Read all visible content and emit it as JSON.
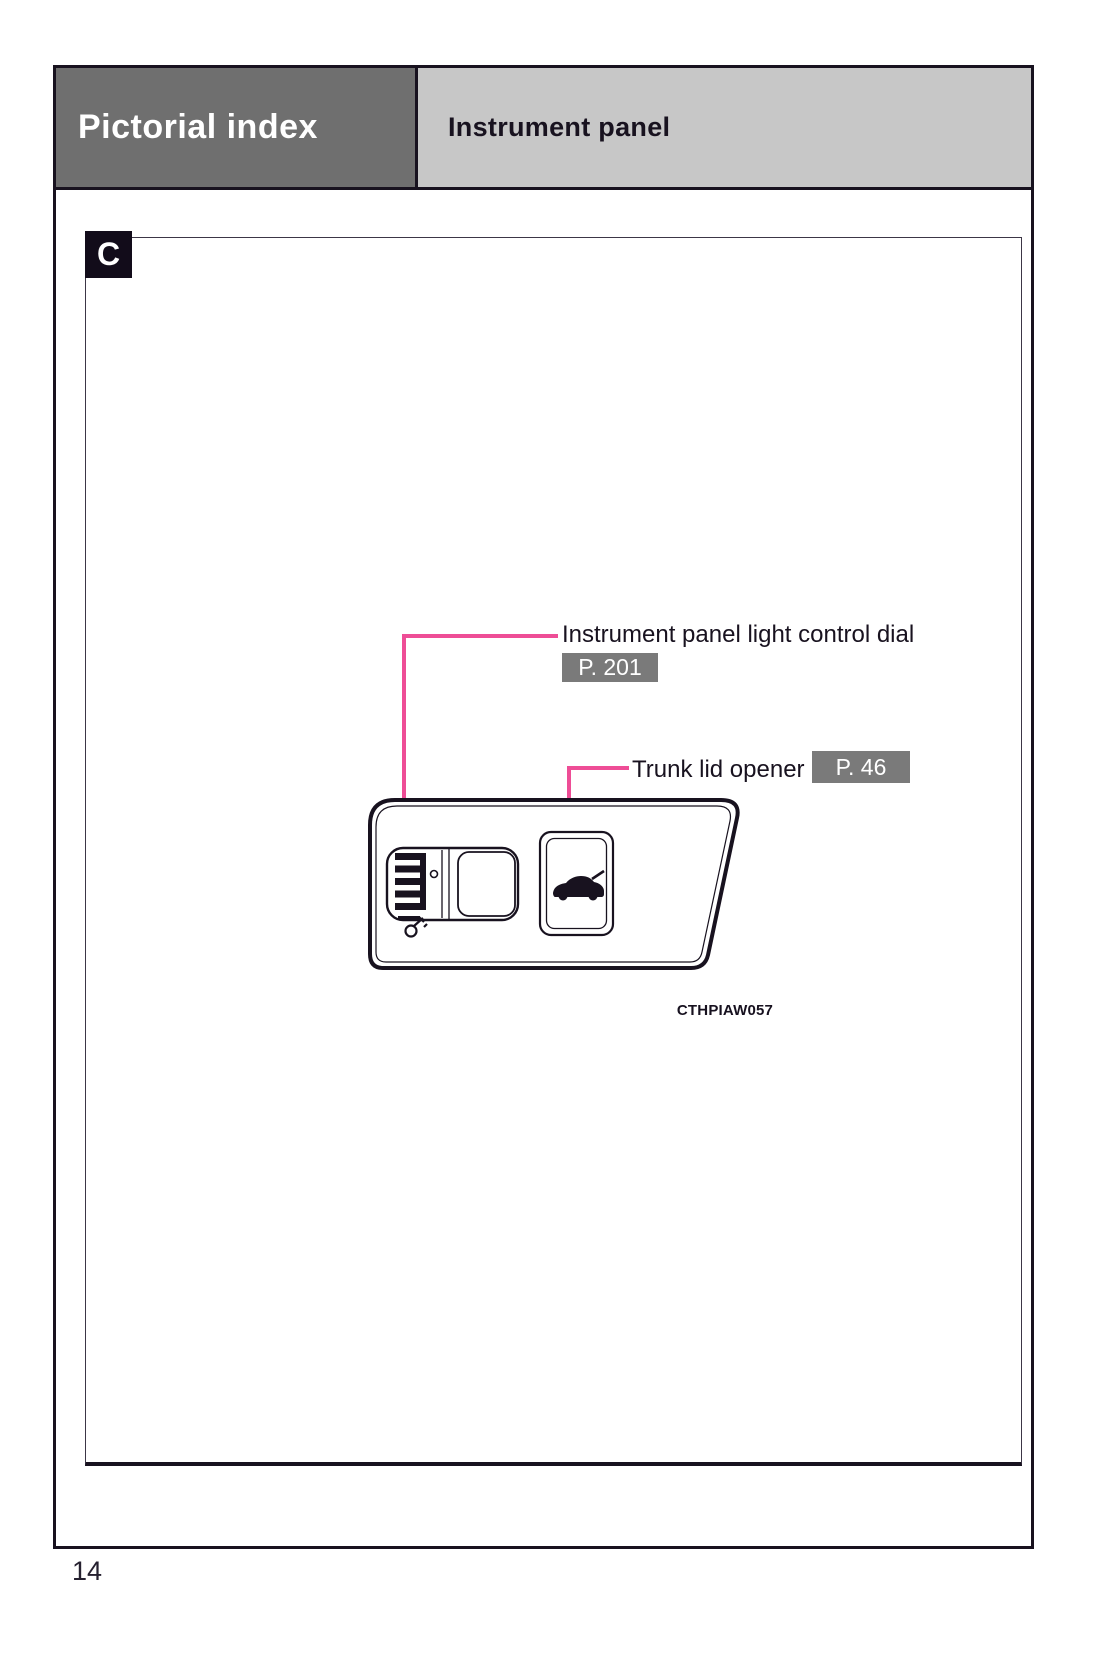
{
  "header": {
    "title": "Pictorial index",
    "subtitle": "Instrument panel"
  },
  "section": {
    "marker": "C"
  },
  "callouts": [
    {
      "label": "Instrument panel light control dial",
      "page_ref": "P. 201"
    },
    {
      "label": "Trunk lid opener",
      "page_ref": "P. 46"
    }
  ],
  "figure": {
    "code": "CTHPIAW057",
    "icons": [
      "instrument-panel-light-dial-icon",
      "trunk-open-button-icon"
    ]
  },
  "page": {
    "number": "14"
  },
  "colors": {
    "accent_pink": "#ee4d96",
    "header_dark_gray": "#6f6f6f",
    "header_light_gray": "#c7c7c7",
    "badge_gray": "#7a7a7a",
    "ink": "#18121f"
  }
}
